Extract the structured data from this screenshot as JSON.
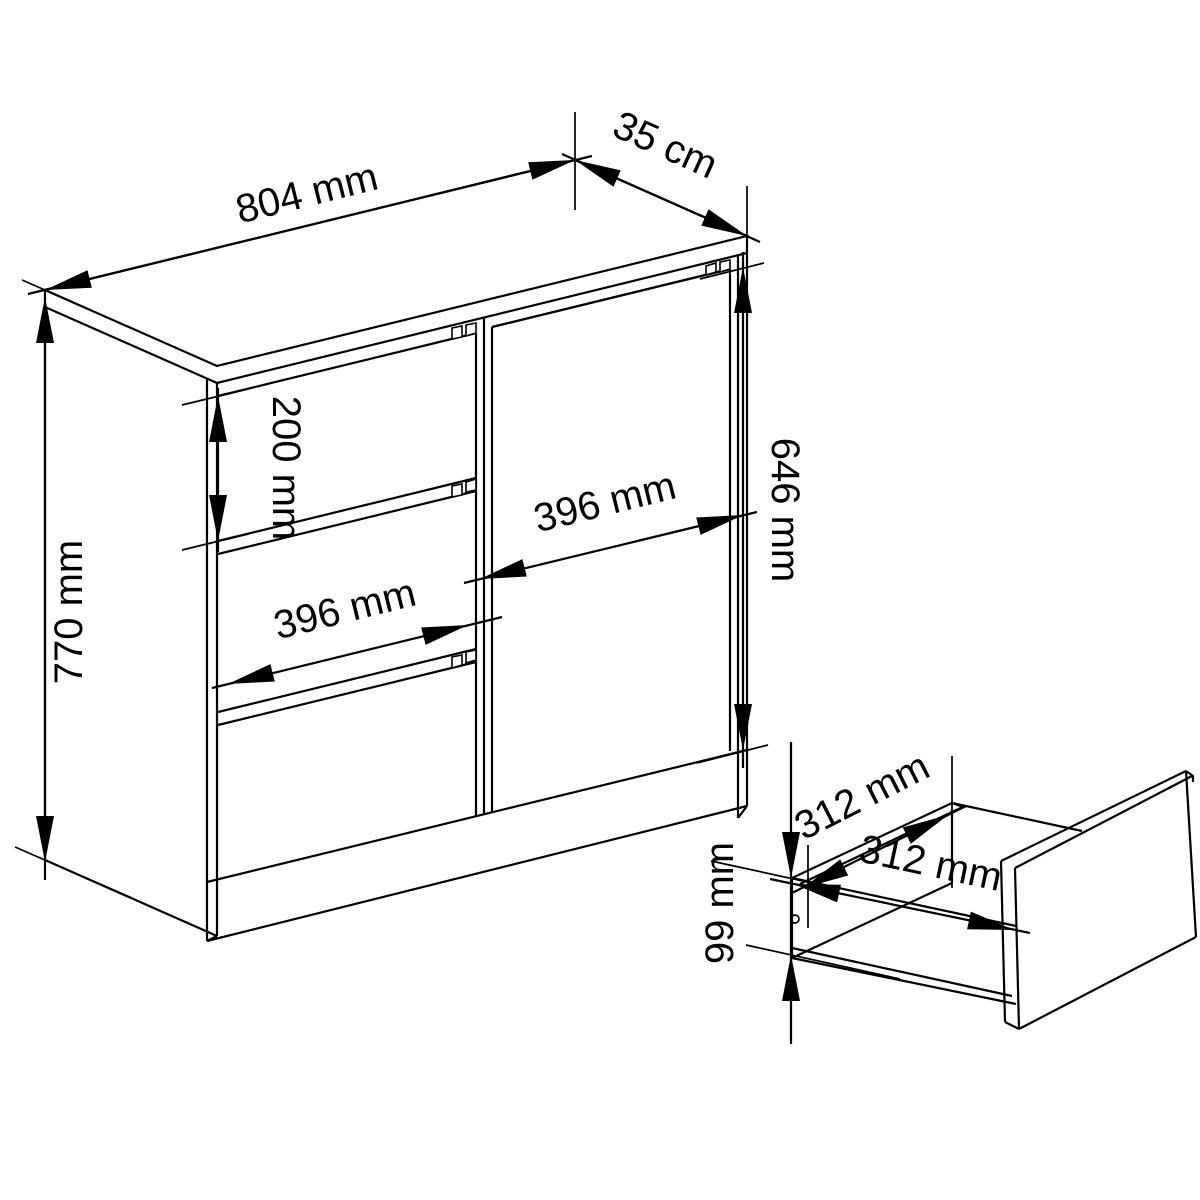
{
  "drawing": {
    "type": "furniture dimension diagram",
    "background_color": "#ffffff",
    "line_color": "#000000"
  },
  "dimensions": {
    "cabinet_width": "804 mm",
    "cabinet_depth": "35 cm",
    "cabinet_height": "770 mm",
    "drawer_height": "200 mm",
    "drawer_width": "396 mm",
    "door_width": "396 mm",
    "door_height": "646 mm",
    "drawer_inner_width": "312 mm",
    "drawer_inner_depth": "312 mm",
    "drawer_inner_height": "99 mm"
  }
}
